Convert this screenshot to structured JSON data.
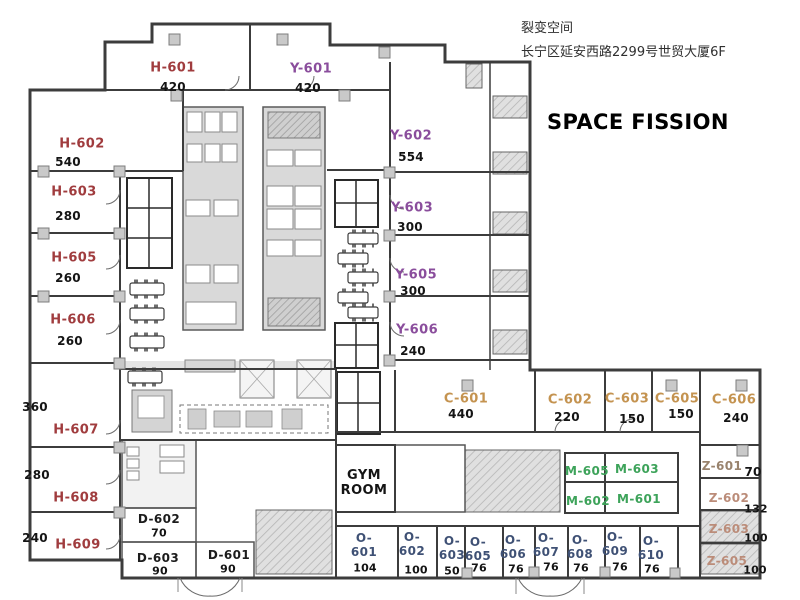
{
  "header": {
    "company": "裂变空间",
    "address": "长宁区延安西路2299号世贸大厦6F",
    "title": "SPACE FISSION"
  },
  "colors": {
    "H": "#a03c3e",
    "Y": "#8a4d9c",
    "C": "#c49350",
    "M": "#3da35a",
    "O": "#3f5175",
    "Z": "#bb8c79",
    "Z1": "#99836d",
    "D": "#1c1c1c",
    "GYM": "#141414",
    "number": "#141414"
  },
  "rooms": [
    {
      "id": "h-601",
      "code": "H-601",
      "group": "H",
      "area": "420",
      "lp": {
        "x": 173,
        "y": 69
      },
      "ap": {
        "x": 173,
        "y": 87
      }
    },
    {
      "id": "y-601",
      "code": "Y-601",
      "group": "Y",
      "area": "420",
      "lp": {
        "x": 311,
        "y": 70
      },
      "ap": {
        "x": 308,
        "y": 88
      }
    },
    {
      "id": "h-602",
      "code": "H-602",
      "group": "H",
      "area": "540",
      "lp": {
        "x": 82,
        "y": 145
      },
      "ap": {
        "x": 68,
        "y": 162
      }
    },
    {
      "id": "h-603",
      "code": "H-603",
      "group": "H",
      "area": "280",
      "lp": {
        "x": 74,
        "y": 193
      },
      "ap": {
        "x": 68,
        "y": 216
      }
    },
    {
      "id": "h-605",
      "code": "H-605",
      "group": "H",
      "area": "260",
      "lp": {
        "x": 74,
        "y": 259
      },
      "ap": {
        "x": 68,
        "y": 278
      }
    },
    {
      "id": "h-606",
      "code": "H-606",
      "group": "H",
      "area": "260",
      "lp": {
        "x": 73,
        "y": 321
      },
      "ap": {
        "x": 70,
        "y": 341
      }
    },
    {
      "id": "h-607",
      "code": "H-607",
      "group": "H",
      "area": "360",
      "lp": {
        "x": 76,
        "y": 431
      },
      "ap": {
        "x": 35,
        "y": 407
      }
    },
    {
      "id": "h-608",
      "code": "H-608",
      "group": "H",
      "area": "280",
      "lp": {
        "x": 76,
        "y": 499
      },
      "ap": {
        "x": 37,
        "y": 475
      }
    },
    {
      "id": "h-609",
      "code": "H-609",
      "group": "H",
      "area": "240",
      "lp": {
        "x": 78,
        "y": 546
      },
      "ap": {
        "x": 35,
        "y": 538
      }
    },
    {
      "id": "y-602",
      "code": "Y-602",
      "group": "Y",
      "area": "554",
      "lp": {
        "x": 411,
        "y": 137
      },
      "ap": {
        "x": 411,
        "y": 157
      }
    },
    {
      "id": "y-603",
      "code": "Y-603",
      "group": "Y",
      "area": "300",
      "lp": {
        "x": 412,
        "y": 209
      },
      "ap": {
        "x": 410,
        "y": 227
      }
    },
    {
      "id": "y-605",
      "code": "Y-605",
      "group": "Y",
      "area": "300",
      "lp": {
        "x": 416,
        "y": 276
      },
      "ap": {
        "x": 413,
        "y": 291
      }
    },
    {
      "id": "y-606",
      "code": "Y-606",
      "group": "Y",
      "area": "240",
      "lp": {
        "x": 417,
        "y": 331
      },
      "ap": {
        "x": 413,
        "y": 351
      }
    },
    {
      "id": "c-601",
      "code": "C-601",
      "group": "C",
      "area": "440",
      "lp": {
        "x": 466,
        "y": 400
      },
      "ap": {
        "x": 461,
        "y": 414
      }
    },
    {
      "id": "c-602",
      "code": "C-602",
      "group": "C",
      "area": "220",
      "lp": {
        "x": 570,
        "y": 401
      },
      "ap": {
        "x": 567,
        "y": 417
      }
    },
    {
      "id": "c-603",
      "code": "C-603",
      "group": "C",
      "area": "150",
      "lp": {
        "x": 627,
        "y": 400
      },
      "ap": {
        "x": 632,
        "y": 419
      }
    },
    {
      "id": "c-605",
      "code": "C-605",
      "group": "C",
      "area": "150",
      "lp": {
        "x": 677,
        "y": 400
      },
      "ap": {
        "x": 681,
        "y": 414
      }
    },
    {
      "id": "c-606",
      "code": "C-606",
      "group": "C",
      "area": "240",
      "lp": {
        "x": 734,
        "y": 401
      },
      "ap": {
        "x": 736,
        "y": 418
      }
    },
    {
      "id": "z-601",
      "code": "Z-601",
      "group": "Z",
      "color": "#99836d",
      "area": "70",
      "size": 12,
      "area_size": 12,
      "lp": {
        "x": 722,
        "y": 467
      },
      "ap": {
        "x": 753,
        "y": 472
      }
    },
    {
      "id": "z-602",
      "code": "Z-602",
      "group": "Z",
      "area": "132",
      "size": 12,
      "area_size": 11,
      "lp": {
        "x": 729,
        "y": 499
      },
      "ap": {
        "x": 756,
        "y": 509
      }
    },
    {
      "id": "z-603",
      "code": "Z-603",
      "group": "Z",
      "area": "100",
      "size": 12,
      "area_size": 11,
      "lp": {
        "x": 729,
        "y": 530
      },
      "ap": {
        "x": 756,
        "y": 538
      }
    },
    {
      "id": "z-605",
      "code": "Z-605",
      "group": "Z",
      "area": "100",
      "size": 12,
      "area_size": 11,
      "lp": {
        "x": 727,
        "y": 562
      },
      "ap": {
        "x": 755,
        "y": 570
      }
    },
    {
      "id": "m-605",
      "code": "M-605",
      "group": "M",
      "size": 12,
      "lp": {
        "x": 587,
        "y": 472
      }
    },
    {
      "id": "m-603",
      "code": "M-603",
      "group": "M",
      "size": 12,
      "lp": {
        "x": 637,
        "y": 470
      }
    },
    {
      "id": "m-602",
      "code": "M-602",
      "group": "M",
      "size": 12,
      "lp": {
        "x": 588,
        "y": 502
      }
    },
    {
      "id": "m-601",
      "code": "M-601",
      "group": "M",
      "size": 12,
      "lp": {
        "x": 639,
        "y": 500
      }
    },
    {
      "id": "d-602",
      "code": "D-602",
      "group": "D",
      "area": "70",
      "size": 12,
      "area_size": 11,
      "lp": {
        "x": 159,
        "y": 520
      },
      "ap": {
        "x": 159,
        "y": 533
      }
    },
    {
      "id": "d-603",
      "code": "D-603",
      "group": "D",
      "area": "90",
      "size": 12,
      "area_size": 11,
      "lp": {
        "x": 158,
        "y": 559
      },
      "ap": {
        "x": 160,
        "y": 571
      }
    },
    {
      "id": "d-601",
      "code": "D-601",
      "group": "D",
      "area": "90",
      "size": 12,
      "area_size": 11,
      "lp": {
        "x": 229,
        "y": 556
      },
      "ap": {
        "x": 228,
        "y": 569
      }
    },
    {
      "id": "gym-room",
      "code": "GYM ROOM",
      "group": "GYM",
      "lines": [
        "GYM",
        "ROOM"
      ],
      "size": 13,
      "lp": {
        "x": 364,
        "y": 484
      }
    },
    {
      "id": "o-601",
      "code": "O-601",
      "group": "O",
      "lines": [
        "O-",
        "601"
      ],
      "area": "104",
      "size": 12,
      "area_size": 11,
      "lp": {
        "x": 364,
        "y": 546
      },
      "ap": {
        "x": 365,
        "y": 568
      }
    },
    {
      "id": "o-602",
      "code": "O-602",
      "group": "O",
      "lines": [
        "O-",
        "602"
      ],
      "area": "100",
      "size": 12,
      "area_size": 11,
      "lp": {
        "x": 412,
        "y": 545
      },
      "ap": {
        "x": 416,
        "y": 570
      }
    },
    {
      "id": "o-603",
      "code": "O-603",
      "group": "O",
      "lines": [
        "O-",
        "603"
      ],
      "area": "50",
      "size": 12,
      "area_size": 11,
      "lp": {
        "x": 452,
        "y": 549
      },
      "ap": {
        "x": 452,
        "y": 571
      }
    },
    {
      "id": "o-605",
      "code": "O-605",
      "group": "O",
      "lines": [
        "O-",
        "605"
      ],
      "area": "76",
      "size": 12,
      "area_size": 11,
      "lp": {
        "x": 478,
        "y": 550
      },
      "ap": {
        "x": 479,
        "y": 568
      }
    },
    {
      "id": "o-606",
      "code": "O-606",
      "group": "O",
      "lines": [
        "O-",
        "606"
      ],
      "area": "76",
      "size": 12,
      "area_size": 11,
      "lp": {
        "x": 513,
        "y": 548
      },
      "ap": {
        "x": 516,
        "y": 569
      }
    },
    {
      "id": "o-607",
      "code": "O-607",
      "group": "O",
      "lines": [
        "O-",
        "607"
      ],
      "area": "76",
      "size": 12,
      "area_size": 11,
      "lp": {
        "x": 546,
        "y": 546
      },
      "ap": {
        "x": 551,
        "y": 567
      }
    },
    {
      "id": "o-608",
      "code": "O-608",
      "group": "O",
      "lines": [
        "O-",
        "608"
      ],
      "area": "76",
      "size": 12,
      "area_size": 11,
      "lp": {
        "x": 580,
        "y": 548
      },
      "ap": {
        "x": 581,
        "y": 568
      }
    },
    {
      "id": "o-609",
      "code": "O-609",
      "group": "O",
      "lines": [
        "O-",
        "609"
      ],
      "area": "76",
      "size": 12,
      "area_size": 11,
      "lp": {
        "x": 615,
        "y": 545
      },
      "ap": {
        "x": 620,
        "y": 567
      }
    },
    {
      "id": "o-610",
      "code": "O-610",
      "group": "O",
      "lines": [
        "O-",
        "610"
      ],
      "area": "76",
      "size": 12,
      "area_size": 11,
      "lp": {
        "x": 651,
        "y": 549
      },
      "ap": {
        "x": 652,
        "y": 569
      }
    }
  ]
}
